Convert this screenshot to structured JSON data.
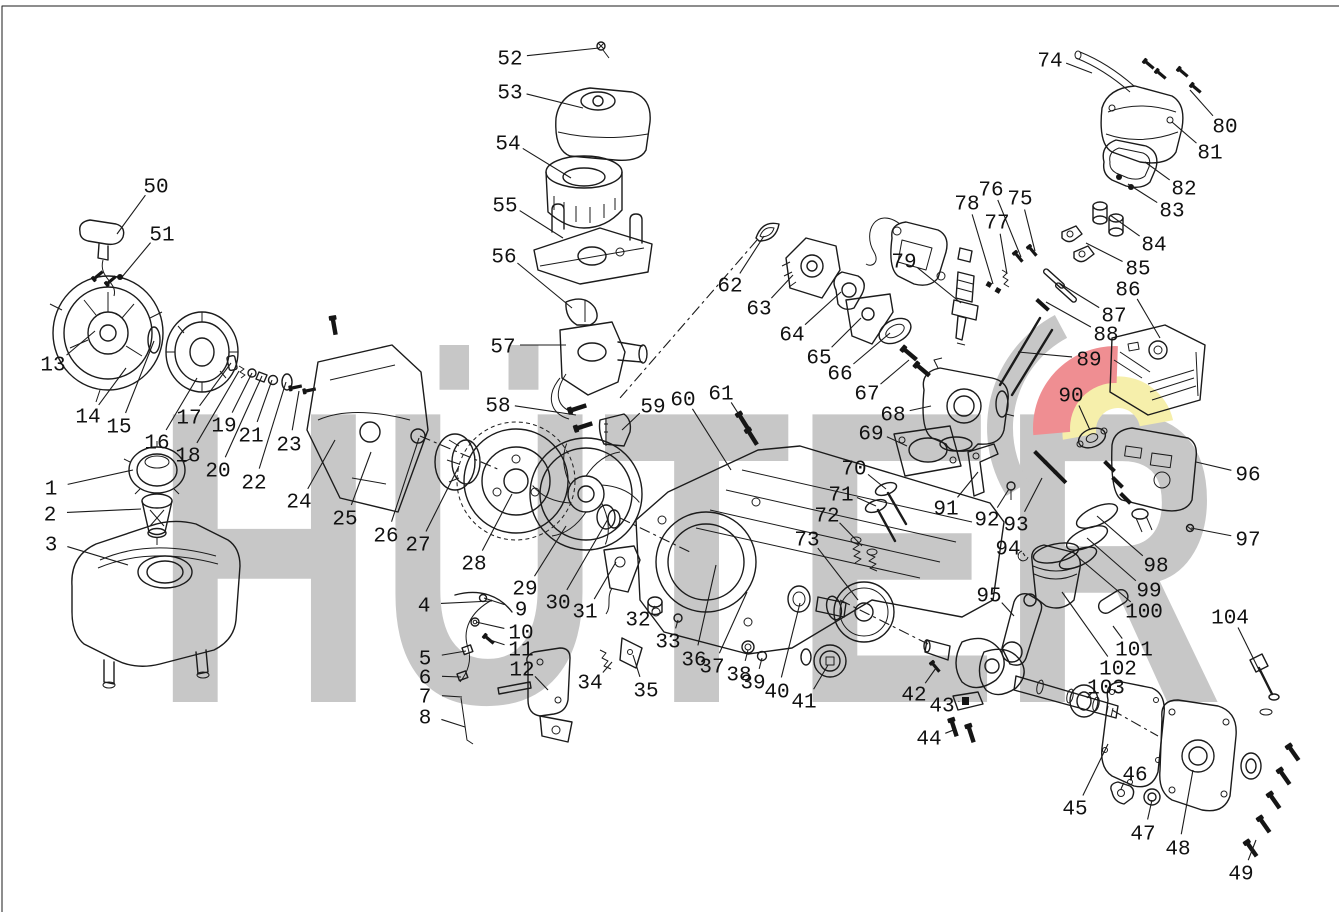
{
  "diagram": {
    "title": "engine-exploded-parts-diagram",
    "background": "#ffffff",
    "line_color": "#1b1b1b",
    "watermark": {
      "text": "HÜTER",
      "color": "#c7c7c7",
      "logo_red": "#ef8e92",
      "logo_yellow": "#f6efab",
      "logo_gray": "#c7c7c7"
    },
    "callouts": [
      {
        "n": "1",
        "x": 51,
        "y": 487,
        "tx": 133,
        "ty": 470
      },
      {
        "n": "2",
        "x": 50,
        "y": 513,
        "tx": 141,
        "ty": 509
      },
      {
        "n": "3",
        "x": 51,
        "y": 543,
        "tx": 128,
        "ty": 565
      },
      {
        "n": "4",
        "x": 424,
        "y": 604,
        "tx": 492,
        "ty": 601
      },
      {
        "n": "5",
        "x": 425,
        "y": 657,
        "tx": 466,
        "ty": 651
      },
      {
        "n": "6",
        "x": 425,
        "y": 676,
        "tx": 461,
        "ty": 677
      },
      {
        "n": "7",
        "x": 425,
        "y": 695,
        "tx": 462,
        "ty": 697
      },
      {
        "n": "8",
        "x": 425,
        "y": 716,
        "tx": 465,
        "ty": 727
      },
      {
        "n": "9",
        "x": 521,
        "y": 608,
        "tx": 484,
        "ty": 598
      },
      {
        "n": "10",
        "x": 521,
        "y": 631,
        "tx": 476,
        "ty": 622
      },
      {
        "n": "11",
        "x": 521,
        "y": 648,
        "tx": 490,
        "ty": 640
      },
      {
        "n": "12",
        "x": 522,
        "y": 668,
        "tx": 548,
        "ty": 690
      },
      {
        "n": "13",
        "x": 53,
        "y": 363,
        "tx": 95,
        "ty": 331
      },
      {
        "n": "14",
        "x": 88,
        "y": 415,
        "tx": 126,
        "ty": 368
      },
      {
        "n": "15",
        "x": 119,
        "y": 425,
        "tx": 154,
        "ty": 341
      },
      {
        "n": "16",
        "x": 157,
        "y": 441,
        "tx": 197,
        "ty": 378
      },
      {
        "n": "17",
        "x": 189,
        "y": 416,
        "tx": 231,
        "ty": 363
      },
      {
        "n": "18",
        "x": 188,
        "y": 454,
        "tx": 239,
        "ty": 371
      },
      {
        "n": "19",
        "x": 224,
        "y": 424,
        "tx": 252,
        "ty": 373
      },
      {
        "n": "20",
        "x": 218,
        "y": 469,
        "tx": 262,
        "ty": 376
      },
      {
        "n": "21",
        "x": 251,
        "y": 434,
        "tx": 272,
        "ty": 380
      },
      {
        "n": "22",
        "x": 254,
        "y": 481,
        "tx": 286,
        "ty": 382
      },
      {
        "n": "23",
        "x": 289,
        "y": 443,
        "tx": 299,
        "ty": 391
      },
      {
        "n": "24",
        "x": 299,
        "y": 500,
        "tx": 335,
        "ty": 440
      },
      {
        "n": "25",
        "x": 345,
        "y": 517,
        "tx": 371,
        "ty": 452
      },
      {
        "n": "26",
        "x": 386,
        "y": 534,
        "tx": 419,
        "ty": 438
      },
      {
        "n": "27",
        "x": 418,
        "y": 543,
        "tx": 459,
        "ty": 466
      },
      {
        "n": "28",
        "x": 474,
        "y": 562,
        "tx": 512,
        "ty": 494
      },
      {
        "n": "29",
        "x": 525,
        "y": 587,
        "tx": 566,
        "ty": 526
      },
      {
        "n": "30",
        "x": 558,
        "y": 601,
        "tx": 608,
        "ty": 519
      },
      {
        "n": "31",
        "x": 585,
        "y": 610,
        "tx": 616,
        "ty": 562
      },
      {
        "n": "32",
        "x": 638,
        "y": 618,
        "tx": 655,
        "ty": 606
      },
      {
        "n": "33",
        "x": 668,
        "y": 640,
        "tx": 678,
        "ty": 620
      },
      {
        "n": "34",
        "x": 590,
        "y": 681,
        "tx": 612,
        "ty": 662
      },
      {
        "n": "35",
        "x": 646,
        "y": 689,
        "tx": 633,
        "ty": 655
      },
      {
        "n": "36",
        "x": 694,
        "y": 658,
        "tx": 716,
        "ty": 565
      },
      {
        "n": "37",
        "x": 712,
        "y": 665,
        "tx": 747,
        "ty": 592
      },
      {
        "n": "38",
        "x": 739,
        "y": 673,
        "tx": 748,
        "ty": 650
      },
      {
        "n": "39",
        "x": 753,
        "y": 681,
        "tx": 762,
        "ty": 658
      },
      {
        "n": "40",
        "x": 777,
        "y": 690,
        "tx": 800,
        "ty": 603
      },
      {
        "n": "41",
        "x": 804,
        "y": 700,
        "tx": 828,
        "ty": 665
      },
      {
        "n": "42",
        "x": 914,
        "y": 693,
        "tx": 936,
        "ty": 668
      },
      {
        "n": "43",
        "x": 942,
        "y": 704,
        "tx": 959,
        "ty": 701
      },
      {
        "n": "44",
        "x": 929,
        "y": 737,
        "tx": 956,
        "ty": 729
      },
      {
        "n": "45",
        "x": 1075,
        "y": 807,
        "tx": 1108,
        "ty": 744
      },
      {
        "n": "46",
        "x": 1135,
        "y": 773,
        "tx": 1121,
        "ty": 789
      },
      {
        "n": "47",
        "x": 1143,
        "y": 832,
        "tx": 1152,
        "ty": 800
      },
      {
        "n": "48",
        "x": 1178,
        "y": 847,
        "tx": 1193,
        "ty": 770
      },
      {
        "n": "49",
        "x": 1241,
        "y": 872,
        "tx": 1256,
        "ty": 840
      },
      {
        "n": "50",
        "x": 156,
        "y": 185,
        "tx": 117,
        "ty": 234
      },
      {
        "n": "51",
        "x": 162,
        "y": 233,
        "tx": 122,
        "ty": 277
      },
      {
        "n": "52",
        "x": 510,
        "y": 57,
        "tx": 599,
        "ty": 48
      },
      {
        "n": "53",
        "x": 510,
        "y": 91,
        "tx": 583,
        "ty": 108
      },
      {
        "n": "54",
        "x": 508,
        "y": 142,
        "tx": 571,
        "ty": 178
      },
      {
        "n": "55",
        "x": 505,
        "y": 204,
        "tx": 563,
        "ty": 238
      },
      {
        "n": "56",
        "x": 504,
        "y": 255,
        "tx": 572,
        "ty": 308
      },
      {
        "n": "57",
        "x": 503,
        "y": 345,
        "tx": 566,
        "ty": 345
      },
      {
        "n": "58",
        "x": 498,
        "y": 404,
        "tx": 576,
        "ty": 415
      },
      {
        "n": "59",
        "x": 653,
        "y": 405,
        "tx": 622,
        "ty": 430
      },
      {
        "n": "60",
        "x": 683,
        "y": 398,
        "tx": 731,
        "ty": 470
      },
      {
        "n": "61",
        "x": 721,
        "y": 392,
        "tx": 745,
        "ty": 424
      },
      {
        "n": "62",
        "x": 730,
        "y": 284,
        "tx": 764,
        "ty": 236
      },
      {
        "n": "63",
        "x": 759,
        "y": 307,
        "tx": 793,
        "ty": 275
      },
      {
        "n": "64",
        "x": 792,
        "y": 333,
        "tx": 841,
        "ty": 292
      },
      {
        "n": "65",
        "x": 819,
        "y": 356,
        "tx": 861,
        "ty": 318
      },
      {
        "n": "66",
        "x": 840,
        "y": 372,
        "tx": 890,
        "ty": 333
      },
      {
        "n": "67",
        "x": 867,
        "y": 392,
        "tx": 909,
        "ty": 360
      },
      {
        "n": "68",
        "x": 893,
        "y": 413,
        "tx": 931,
        "ty": 406
      },
      {
        "n": "69",
        "x": 871,
        "y": 432,
        "tx": 907,
        "ty": 446
      },
      {
        "n": "70",
        "x": 854,
        "y": 467,
        "tx": 886,
        "ty": 489
      },
      {
        "n": "71",
        "x": 841,
        "y": 493,
        "tx": 876,
        "ty": 506
      },
      {
        "n": "72",
        "x": 827,
        "y": 514,
        "tx": 862,
        "ty": 546
      },
      {
        "n": "73",
        "x": 807,
        "y": 538,
        "tx": 858,
        "ty": 600
      },
      {
        "n": "74",
        "x": 1050,
        "y": 59,
        "tx": 1092,
        "ty": 73
      },
      {
        "n": "75",
        "x": 1020,
        "y": 197,
        "tx": 1035,
        "ty": 251
      },
      {
        "n": "76",
        "x": 991,
        "y": 188,
        "tx": 1021,
        "ty": 257
      },
      {
        "n": "77",
        "x": 997,
        "y": 221,
        "tx": 1007,
        "ty": 274
      },
      {
        "n": "78",
        "x": 967,
        "y": 202,
        "tx": 993,
        "ty": 284
      },
      {
        "n": "79",
        "x": 904,
        "y": 260,
        "tx": 961,
        "ty": 303
      },
      {
        "n": "80",
        "x": 1225,
        "y": 125,
        "tx": 1190,
        "ty": 90
      },
      {
        "n": "81",
        "x": 1210,
        "y": 151,
        "tx": 1172,
        "ty": 122
      },
      {
        "n": "82",
        "x": 1184,
        "y": 187,
        "tx": 1145,
        "ty": 162
      },
      {
        "n": "83",
        "x": 1172,
        "y": 209,
        "tx": 1128,
        "ty": 184
      },
      {
        "n": "84",
        "x": 1154,
        "y": 243,
        "tx": 1110,
        "ty": 215
      },
      {
        "n": "85",
        "x": 1138,
        "y": 267,
        "tx": 1086,
        "ty": 243
      },
      {
        "n": "86",
        "x": 1128,
        "y": 288,
        "tx": 1160,
        "ty": 338
      },
      {
        "n": "87",
        "x": 1114,
        "y": 314,
        "tx": 1059,
        "ty": 283
      },
      {
        "n": "88",
        "x": 1106,
        "y": 333,
        "tx": 1046,
        "ty": 302
      },
      {
        "n": "89",
        "x": 1089,
        "y": 358,
        "tx": 1018,
        "ty": 352
      },
      {
        "n": "90",
        "x": 1071,
        "y": 394,
        "tx": 1090,
        "ty": 430
      },
      {
        "n": "91",
        "x": 946,
        "y": 507,
        "tx": 978,
        "ty": 472
      },
      {
        "n": "92",
        "x": 987,
        "y": 518,
        "tx": 1009,
        "ty": 489
      },
      {
        "n": "93",
        "x": 1016,
        "y": 523,
        "tx": 1042,
        "ty": 478
      },
      {
        "n": "94",
        "x": 1008,
        "y": 547,
        "tx": 1025,
        "ty": 556
      },
      {
        "n": "95",
        "x": 989,
        "y": 594,
        "tx": 1014,
        "ty": 616
      },
      {
        "n": "96",
        "x": 1248,
        "y": 473,
        "tx": 1196,
        "ty": 462
      },
      {
        "n": "97",
        "x": 1248,
        "y": 538,
        "tx": 1191,
        "ty": 528
      },
      {
        "n": "98",
        "x": 1156,
        "y": 564,
        "tx": 1097,
        "ty": 516
      },
      {
        "n": "99",
        "x": 1149,
        "y": 589,
        "tx": 1087,
        "ty": 538
      },
      {
        "n": "100",
        "x": 1144,
        "y": 610,
        "tx": 1079,
        "ty": 558
      },
      {
        "n": "101",
        "x": 1134,
        "y": 648,
        "tx": 1113,
        "ty": 626
      },
      {
        "n": "102",
        "x": 1118,
        "y": 667,
        "tx": 1062,
        "ty": 592
      },
      {
        "n": "103",
        "x": 1106,
        "y": 686,
        "tx": 1087,
        "ty": 698
      },
      {
        "n": "104",
        "x": 1230,
        "y": 616,
        "tx": 1260,
        "ty": 672
      }
    ]
  }
}
